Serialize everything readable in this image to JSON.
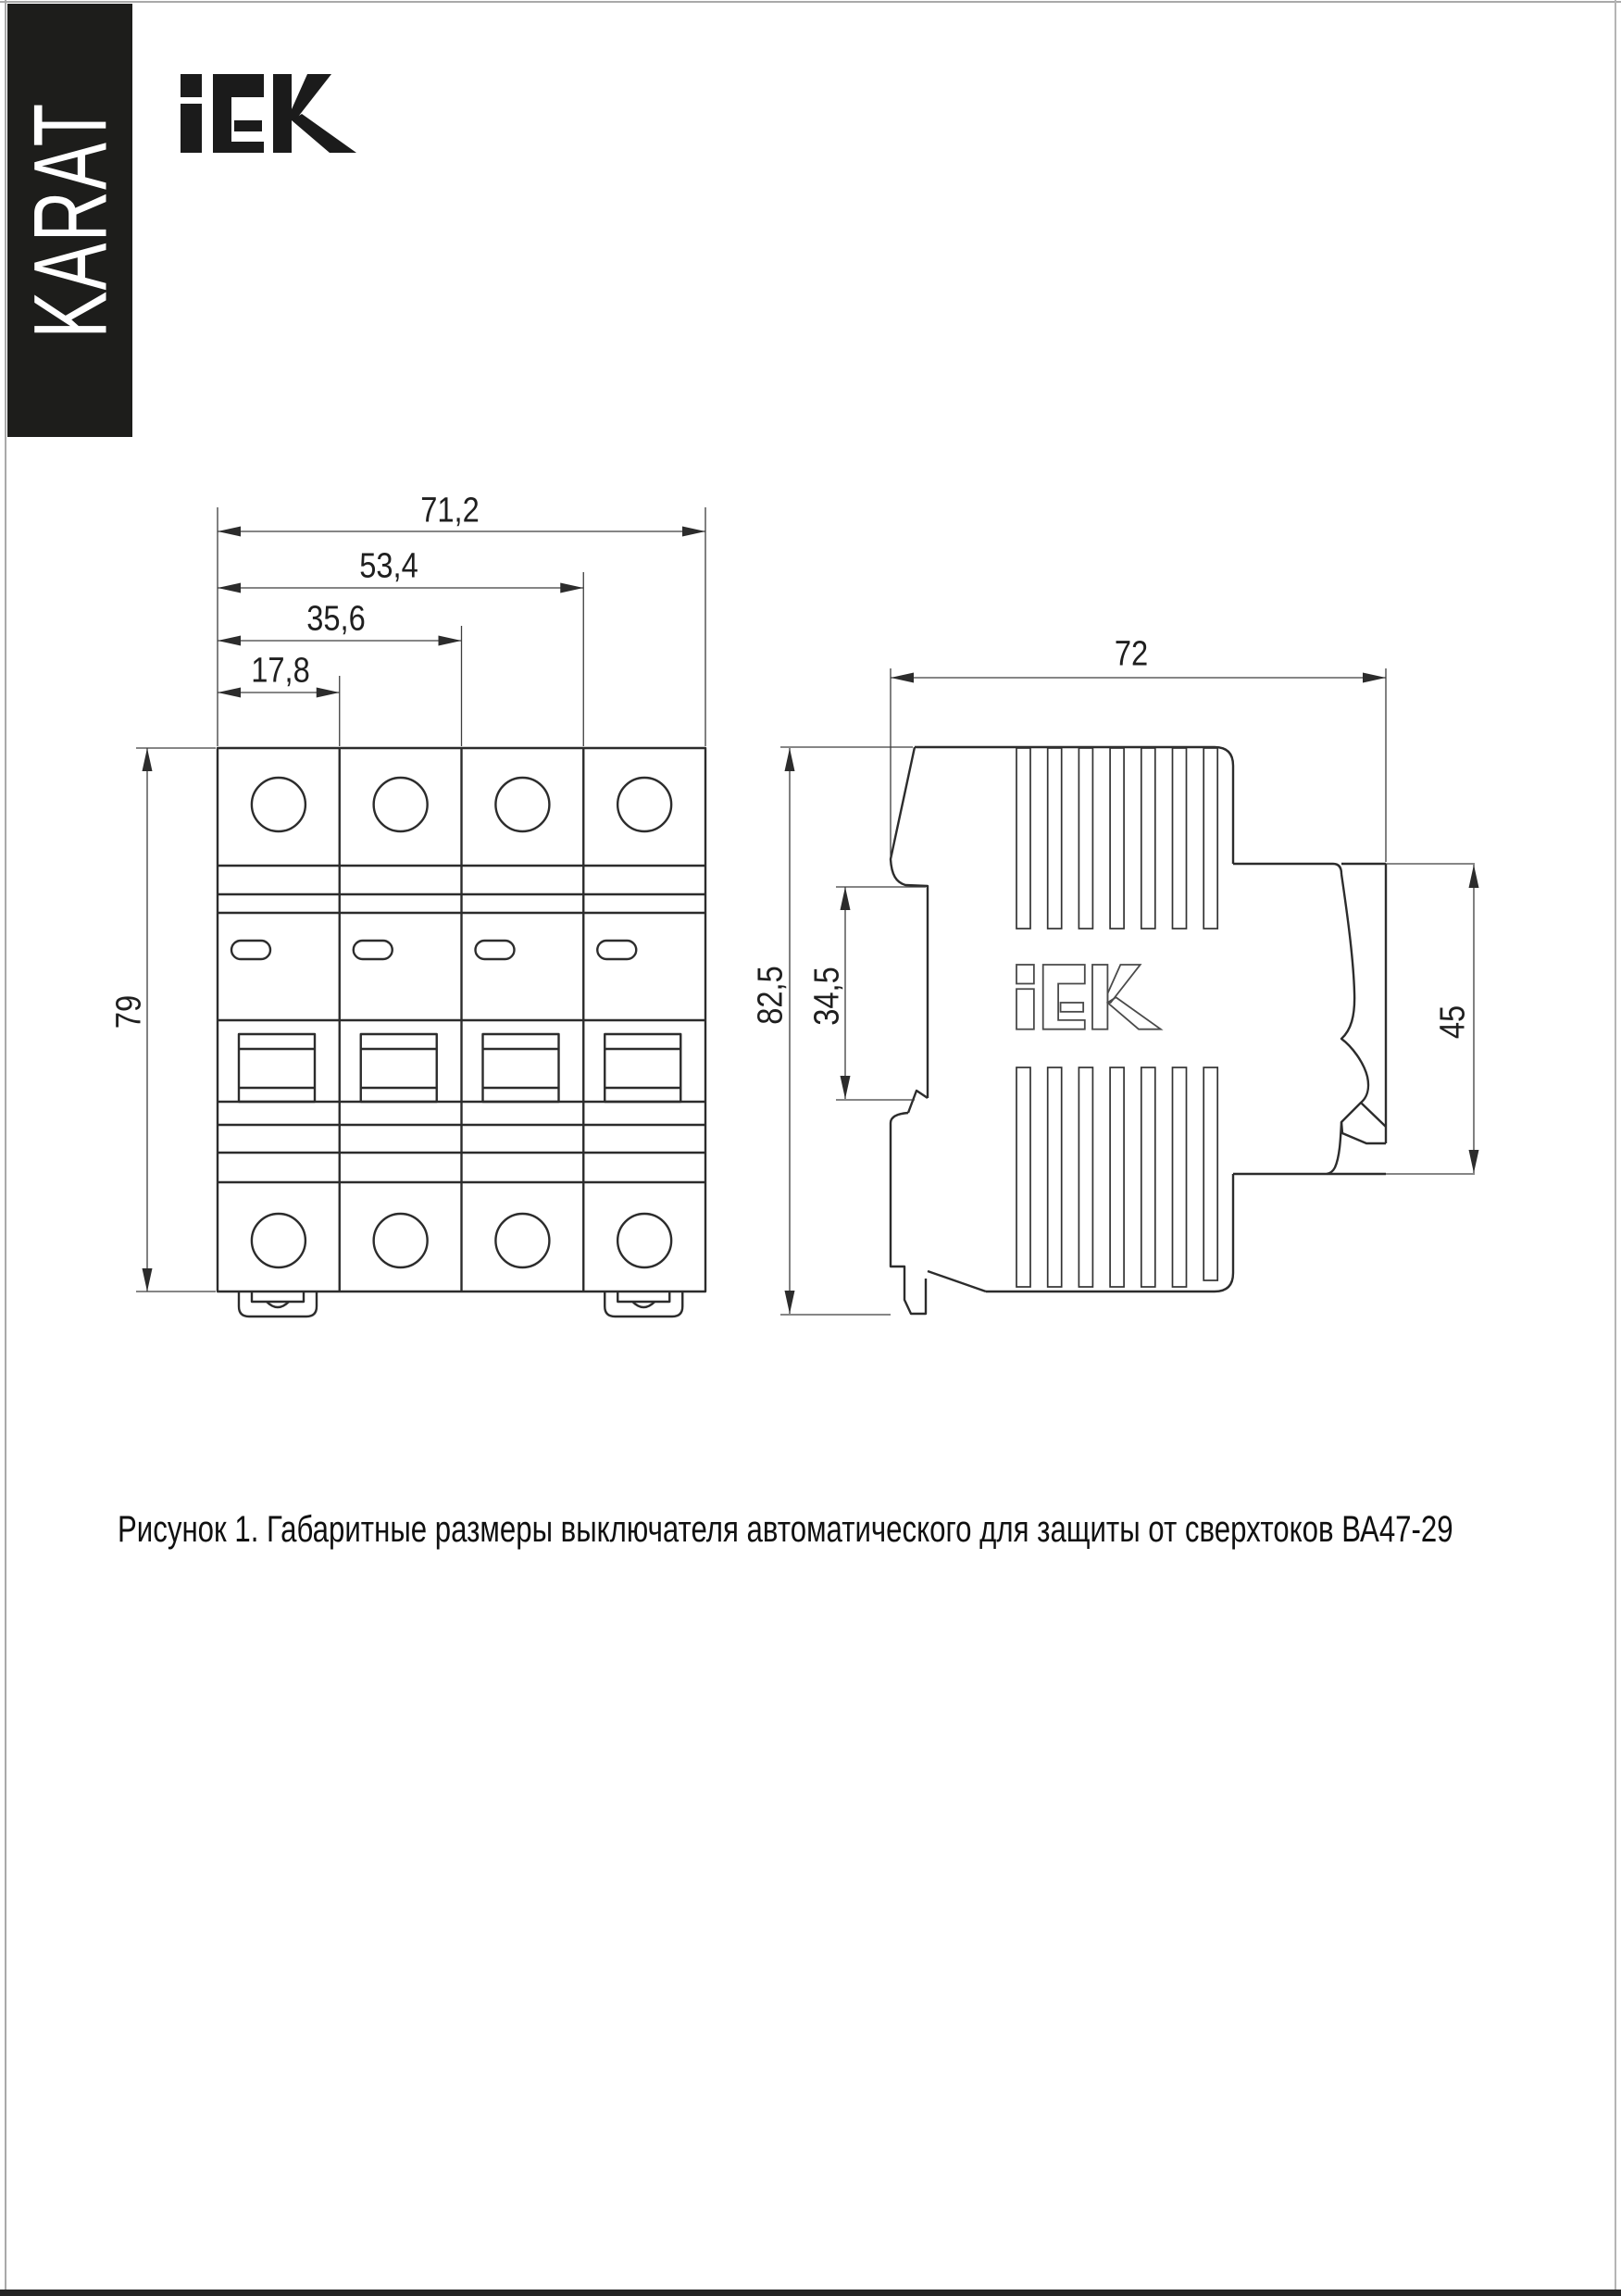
{
  "page": {
    "background": "#ffffff",
    "frame_color": "#a9a9a9",
    "footer_bar_color": "#242424"
  },
  "branding": {
    "karat": "KARAT",
    "banner_color": "#1d1d1b",
    "iek_logo": "iEK"
  },
  "drawing": {
    "front_view": {
      "dim_width_total": "71,2",
      "dim_width_three_modules": "53,4",
      "dim_width_two_modules": "35,6",
      "dim_width_one_module": "17,8",
      "dim_height": "79"
    },
    "side_view": {
      "dim_depth": "72",
      "dim_height_total": "82,5",
      "dim_rail_slot": "34,5",
      "dim_front_height": "45",
      "embossed_logo": "iEK"
    }
  },
  "caption": "Рисунок 1. Габаритные размеры выключателя автоматического для защиты от сверхтоков ВА47-29"
}
